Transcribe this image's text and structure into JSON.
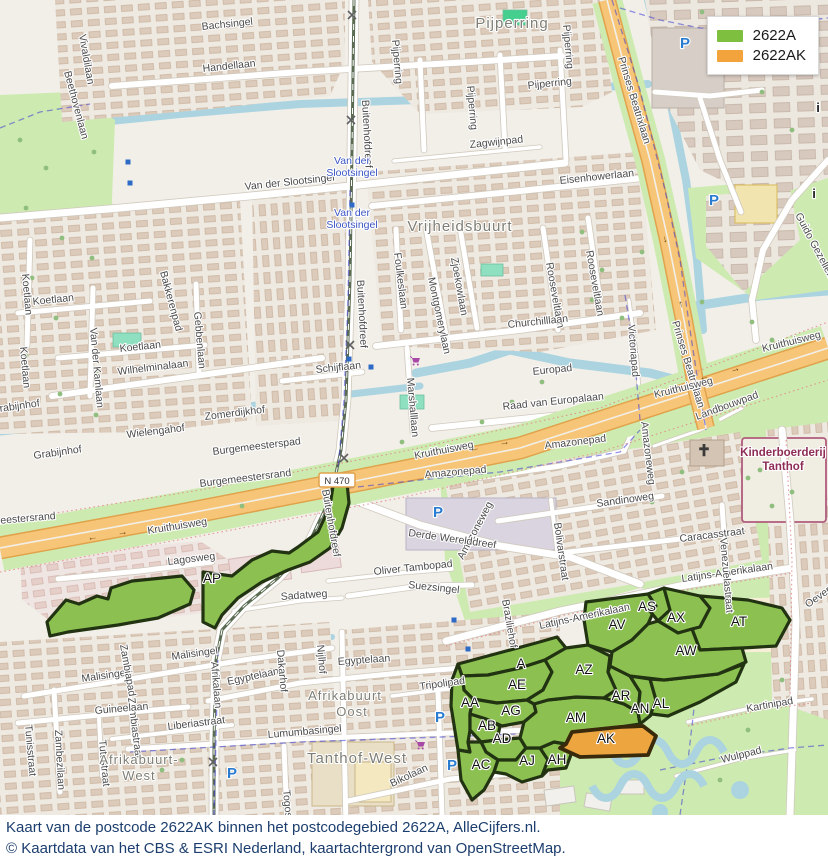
{
  "legend": {
    "items": [
      {
        "label": "2622A",
        "color": "#7fbf3f"
      },
      {
        "label": "2622AK",
        "color": "#f2a33c"
      }
    ]
  },
  "caption": {
    "line1": "Kaart van de postcode 2622AK binnen het postcodegebied 2622A, AlleCijfers.nl.",
    "line2": "© Kaartdata van het CBS & ESRI Nederland, kaartachtergrond van OpenStreetMap."
  },
  "colors": {
    "area_green": "#8cc152",
    "area_green_stroke": "#223312",
    "area_orange": "#eda53f",
    "area_orange_stroke": "#3a2a0c",
    "water": "#abd4e0",
    "park": "#cdebb0",
    "road_orange": "#f7c577",
    "transit_blue": "#3b55c4",
    "poi_red": "#8e2c55"
  },
  "map": {
    "road_badge": {
      "text": "N 470",
      "x": 337,
      "y": 481
    },
    "postcode_areas": [
      {
        "code": "AP",
        "x": 212,
        "y": 583
      },
      {
        "code": "A",
        "x": 521,
        "y": 668
      },
      {
        "code": "AE",
        "x": 517,
        "y": 689
      },
      {
        "code": "AA",
        "x": 470,
        "y": 707
      },
      {
        "code": "AG",
        "x": 511,
        "y": 715
      },
      {
        "code": "AB",
        "x": 487,
        "y": 730
      },
      {
        "code": "AD",
        "x": 502,
        "y": 743
      },
      {
        "code": "AC",
        "x": 481,
        "y": 769
      },
      {
        "code": "AJ",
        "x": 527,
        "y": 765
      },
      {
        "code": "AH",
        "x": 557,
        "y": 764
      },
      {
        "code": "AM",
        "x": 576,
        "y": 722
      },
      {
        "code": "AZ",
        "x": 584,
        "y": 674
      },
      {
        "code": "AR",
        "x": 621,
        "y": 700
      },
      {
        "code": "AN",
        "x": 640,
        "y": 713
      },
      {
        "code": "AL",
        "x": 661,
        "y": 708
      },
      {
        "code": "AV",
        "x": 617,
        "y": 629
      },
      {
        "code": "AS",
        "x": 647,
        "y": 611
      },
      {
        "code": "AX",
        "x": 676,
        "y": 622
      },
      {
        "code": "AT",
        "x": 739,
        "y": 626
      },
      {
        "code": "AW",
        "x": 686,
        "y": 655
      },
      {
        "code": "AK",
        "x": 606,
        "y": 743,
        "highlight": true
      }
    ],
    "street_labels": [
      {
        "t": "Vivaldilaan",
        "x": 79,
        "y": 35,
        "r": 80
      },
      {
        "t": "Beethovenlaan",
        "x": 64,
        "y": 72,
        "r": 75
      },
      {
        "t": "Bachsingel",
        "x": 202,
        "y": 30,
        "r": -6
      },
      {
        "t": "Handellaan",
        "x": 203,
        "y": 72,
        "r": -6
      },
      {
        "t": "Van der Slootsingel",
        "x": 245,
        "y": 190,
        "r": -6
      },
      {
        "t": "Zagwijnpad",
        "x": 470,
        "y": 148,
        "r": -6
      },
      {
        "t": "Eisenhowerlaan",
        "x": 560,
        "y": 184,
        "r": -6
      },
      {
        "t": "Pijperring",
        "x": 392,
        "y": 40,
        "r": 85
      },
      {
        "t": "Pijperring",
        "x": 467,
        "y": 86,
        "r": 85
      },
      {
        "t": "Pijperring",
        "x": 528,
        "y": 89,
        "r": -6
      },
      {
        "t": "Pijperring",
        "x": 563,
        "y": 25,
        "r": 85
      },
      {
        "t": "Prinses Beatrixlaan",
        "x": 618,
        "y": 58,
        "r": 73
      },
      {
        "t": "Prinses Beatrixlaan",
        "x": 672,
        "y": 322,
        "r": 73
      },
      {
        "t": "Guido Gezellelaan",
        "x": 795,
        "y": 215,
        "r": 62
      },
      {
        "t": "Buitenhofdreef",
        "x": 362,
        "y": 100,
        "r": 87
      },
      {
        "t": "Buitenhofdreef",
        "x": 357,
        "y": 280,
        "r": 87
      },
      {
        "t": "Buitenhofdreef",
        "x": 322,
        "y": 490,
        "r": 80
      },
      {
        "t": "Foulkeslaan",
        "x": 394,
        "y": 253,
        "r": 83
      },
      {
        "t": "Montgomerylaan",
        "x": 428,
        "y": 278,
        "r": 78
      },
      {
        "t": "Zjoekowlaan",
        "x": 451,
        "y": 258,
        "r": 80
      },
      {
        "t": "Rooseveltlaan",
        "x": 546,
        "y": 263,
        "r": 80
      },
      {
        "t": "Rooseveltlaan",
        "x": 586,
        "y": 251,
        "r": 80
      },
      {
        "t": "Churchilllaan",
        "x": 508,
        "y": 328,
        "r": -6
      },
      {
        "t": "Europad",
        "x": 533,
        "y": 375,
        "r": -6
      },
      {
        "t": "Raad van Europalaan",
        "x": 503,
        "y": 410,
        "r": -6
      },
      {
        "t": "Marshalllaan",
        "x": 407,
        "y": 378,
        "r": 85
      },
      {
        "t": "Schijflaan",
        "x": 316,
        "y": 373,
        "r": -6
      },
      {
        "t": "Koetlaan",
        "x": 33,
        "y": 305,
        "r": -6
      },
      {
        "t": "Koetlaan",
        "x": 120,
        "y": 352,
        "r": -6
      },
      {
        "t": "Koetlaan",
        "x": 22,
        "y": 274,
        "r": 85
      },
      {
        "t": "Koetlaan",
        "x": 20,
        "y": 347,
        "r": 85
      },
      {
        "t": "Van der Kamlaan",
        "x": 90,
        "y": 328,
        "r": 85
      },
      {
        "t": "Bakkerenpad",
        "x": 160,
        "y": 272,
        "r": 75
      },
      {
        "t": "Gebbenlaan",
        "x": 194,
        "y": 312,
        "r": 85
      },
      {
        "t": "Wilhelminalaan",
        "x": 118,
        "y": 375,
        "r": -7
      },
      {
        "t": "Zomerdijkhof",
        "x": 205,
        "y": 420,
        "r": -7
      },
      {
        "t": "Wielengahof",
        "x": 127,
        "y": 438,
        "r": -7
      },
      {
        "t": "Grabijnhof",
        "x": 34,
        "y": 459,
        "r": -8
      },
      {
        "t": "Grabijnhof",
        "x": -8,
        "y": 413,
        "r": -8
      },
      {
        "t": "Burgemeesterspad",
        "x": 213,
        "y": 455,
        "r": -7
      },
      {
        "t": "Burgemeestersrand",
        "x": 200,
        "y": 487,
        "r": -7
      },
      {
        "t": "Burgemeestersrand",
        "x": -36,
        "y": 527,
        "r": -5
      },
      {
        "t": "Kruithuisweg",
        "x": 148,
        "y": 534,
        "r": -9
      },
      {
        "t": "Kruithuisweg",
        "x": 415,
        "y": 459,
        "r": -11
      },
      {
        "t": "Kruithuisweg",
        "x": 655,
        "y": 398,
        "r": -14
      },
      {
        "t": "Kruithuisweg",
        "x": 763,
        "y": 352,
        "r": -14
      },
      {
        "t": "Amazonepad",
        "x": 425,
        "y": 478,
        "r": -5
      },
      {
        "t": "Amazonepad",
        "x": 545,
        "y": 449,
        "r": -7
      },
      {
        "t": "Amazoneweg",
        "x": 641,
        "y": 422,
        "r": 83
      },
      {
        "t": "Amazoneweg",
        "x": 463,
        "y": 560,
        "r": -62
      },
      {
        "t": "Victoriapad",
        "x": 628,
        "y": 325,
        "r": 85
      },
      {
        "t": "Landbouwpad",
        "x": 697,
        "y": 420,
        "r": -20
      },
      {
        "t": "Derde Werelddreef",
        "x": 408,
        "y": 536,
        "r": 8
      },
      {
        "t": "Oliver Tambopad",
        "x": 374,
        "y": 575,
        "r": -6
      },
      {
        "t": "Suezsingel",
        "x": 408,
        "y": 588,
        "r": 6
      },
      {
        "t": "Sadatweg",
        "x": 281,
        "y": 600,
        "r": -4
      },
      {
        "t": "Lagosweg",
        "x": 168,
        "y": 565,
        "r": -7
      },
      {
        "t": "Malisingel",
        "x": 172,
        "y": 660,
        "r": -8
      },
      {
        "t": "Malisingel",
        "x": 82,
        "y": 682,
        "r": -8
      },
      {
        "t": "Egyptelaan",
        "x": 228,
        "y": 685,
        "r": -12
      },
      {
        "t": "Egyptelaan",
        "x": 338,
        "y": 665,
        "r": -4
      },
      {
        "t": "Afrikalaan",
        "x": 211,
        "y": 662,
        "r": 85
      },
      {
        "t": "Zambiapad",
        "x": 120,
        "y": 645,
        "r": 80
      },
      {
        "t": "Zambiastraat",
        "x": 128,
        "y": 698,
        "r": 83
      },
      {
        "t": "Zambezilaan",
        "x": 55,
        "y": 730,
        "r": 87
      },
      {
        "t": "Tutustraat",
        "x": 99,
        "y": 740,
        "r": 85
      },
      {
        "t": "Tunisstraat",
        "x": 25,
        "y": 725,
        "r": 85
      },
      {
        "t": "Guineelaan",
        "x": 95,
        "y": 714,
        "r": -5
      },
      {
        "t": "Liberiastraat",
        "x": 168,
        "y": 730,
        "r": -7
      },
      {
        "t": "Lumumbasingel",
        "x": 268,
        "y": 738,
        "r": -5
      },
      {
        "t": "Togostraat",
        "x": 283,
        "y": 790,
        "r": 85
      },
      {
        "t": "Bikolaan",
        "x": 392,
        "y": 787,
        "r": -25
      },
      {
        "t": "Tripolipad",
        "x": 420,
        "y": 690,
        "r": -8
      },
      {
        "t": "Dakarhof",
        "x": 277,
        "y": 650,
        "r": 85
      },
      {
        "t": "Nijlhof",
        "x": 317,
        "y": 645,
        "r": 85
      },
      {
        "t": "Latijns-Amerikalaan",
        "x": 540,
        "y": 629,
        "r": -12
      },
      {
        "t": "Latijns-Amerikalaan",
        "x": 682,
        "y": 582,
        "r": -8
      },
      {
        "t": "Sandinoweg",
        "x": 597,
        "y": 507,
        "r": -8
      },
      {
        "t": "Bolivarstraat",
        "x": 554,
        "y": 523,
        "r": 82
      },
      {
        "t": "Caracasstraat",
        "x": 680,
        "y": 542,
        "r": -7
      },
      {
        "t": "Venezuelastraat",
        "x": 720,
        "y": 538,
        "r": 85
      },
      {
        "t": "Braziliehof",
        "x": 502,
        "y": 600,
        "r": 80
      },
      {
        "t": "Kartinipad",
        "x": 747,
        "y": 712,
        "r": -10
      },
      {
        "t": "Wulppad",
        "x": 722,
        "y": 763,
        "r": -14
      },
      {
        "t": "Oeverloper",
        "x": 808,
        "y": 608,
        "r": -35
      }
    ],
    "transit_labels": [
      {
        "lines": [
          "Van der",
          "Slootsingel"
        ],
        "x": 352,
        "y": 164
      },
      {
        "lines": [
          "Van der",
          "Slootsingel"
        ],
        "x": 352,
        "y": 216
      }
    ],
    "place_labels": [
      {
        "t": "Pijperring",
        "x": 512,
        "y": 28,
        "s": 15
      },
      {
        "t": "Vrijheidsbuurt",
        "x": 460,
        "y": 231,
        "s": 15
      },
      {
        "t": "Tanthof-West",
        "x": 357,
        "y": 763,
        "s": 15
      },
      {
        "t": "Afrikabuurt",
        "x": 345,
        "y": 700,
        "s": 13
      },
      {
        "t": "Oost",
        "x": 352,
        "y": 716,
        "s": 13
      },
      {
        "t": "Afrikabuurt-",
        "x": 139,
        "y": 764,
        "s": 13
      },
      {
        "t": "West",
        "x": 139,
        "y": 780,
        "s": 13
      }
    ],
    "poi_labels": [
      {
        "lines": [
          "Kinderboerderij",
          "Tanthof"
        ],
        "x": 783,
        "y": 456
      }
    ],
    "icons": {
      "parking": [
        [
          685,
          48
        ],
        [
          714,
          205
        ],
        [
          438,
          517
        ],
        [
          440,
          722
        ],
        [
          452,
          770
        ],
        [
          232,
          778
        ]
      ],
      "info": [
        [
          818,
          112
        ],
        [
          814,
          198
        ]
      ],
      "church": [
        [
          704,
          453
        ]
      ],
      "cart": [
        [
          416,
          362
        ],
        [
          421,
          746
        ]
      ],
      "stop_squares": [
        [
          128,
          162
        ],
        [
          130,
          183
        ],
        [
          352,
          205
        ],
        [
          349,
          359
        ],
        [
          371,
          367
        ],
        [
          454,
          620
        ],
        [
          468,
          649
        ]
      ],
      "rail_crossings": [
        [
          352,
          15
        ],
        [
          351,
          120
        ],
        [
          350,
          345
        ],
        [
          344,
          458
        ],
        [
          213,
          762
        ]
      ],
      "road_arrows": [
        {
          "x": 88,
          "y": 541,
          "r": -10,
          "g": "←"
        },
        {
          "x": 118,
          "y": 536,
          "r": -10,
          "g": "→"
        },
        {
          "x": 470,
          "y": 452,
          "r": -11,
          "g": "←"
        },
        {
          "x": 500,
          "y": 446,
          "r": -11,
          "g": "→"
        },
        {
          "x": 700,
          "y": 381,
          "r": -15,
          "g": "←"
        },
        {
          "x": 731,
          "y": 373,
          "r": -15,
          "g": "→"
        },
        {
          "x": 662,
          "y": 235,
          "r": 75,
          "g": "→"
        },
        {
          "x": 678,
          "y": 300,
          "r": 75,
          "g": "←"
        }
      ]
    }
  }
}
